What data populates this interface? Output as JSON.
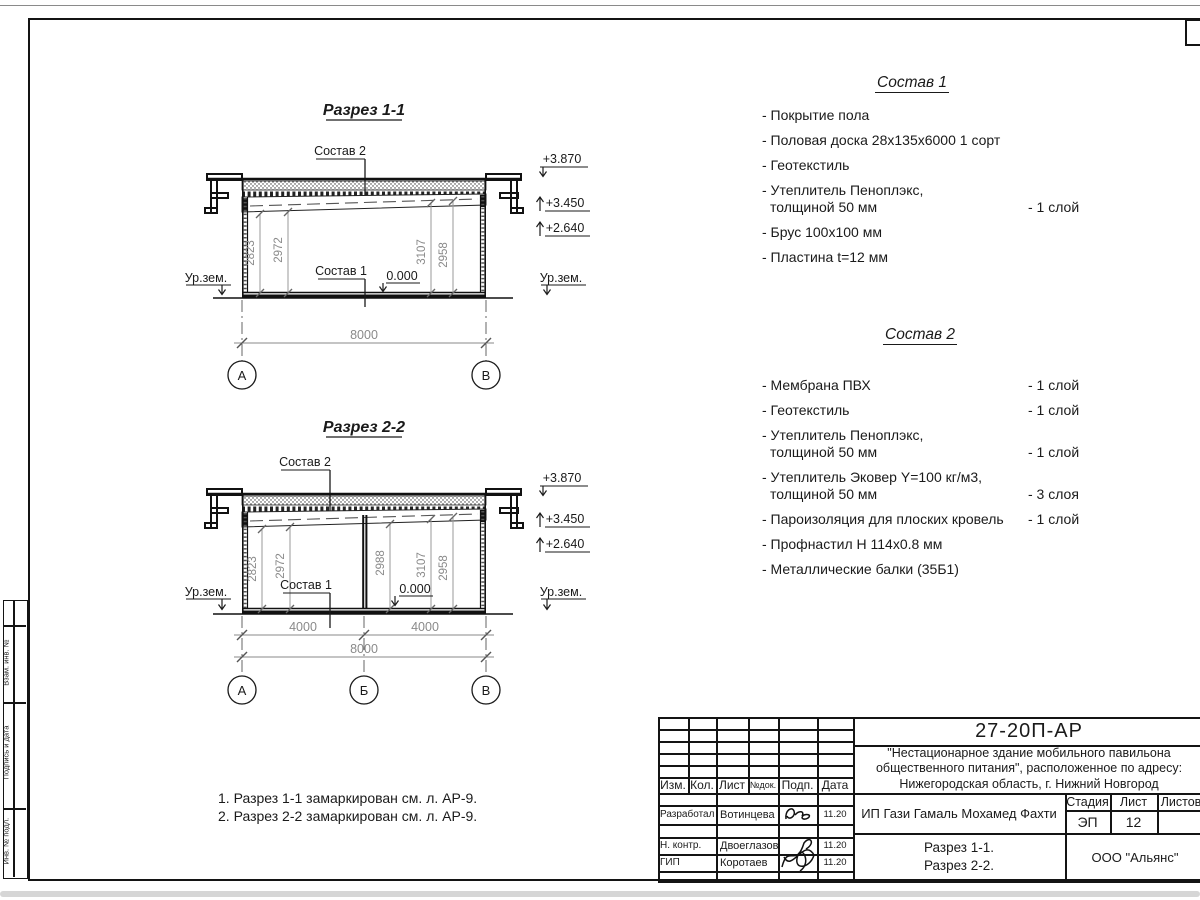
{
  "side_strip": {
    "labels": [
      "Взам. инв. №",
      "Подпись и дата",
      "Инв. № подл."
    ]
  },
  "sections": [
    {
      "title": "Разрез 1-1",
      "callout_roof": "Состав 2",
      "callout_floor": "Состав 1",
      "zero": "0.000",
      "ground_left": "Ур.зем.",
      "ground_right": "Ур.зем.",
      "levels": [
        "+3.870",
        "+3.450",
        "+2.640"
      ],
      "dims": [
        "2823",
        "2972",
        "3107",
        "2958"
      ],
      "overall": "8000",
      "axes": [
        "А",
        "В"
      ]
    },
    {
      "title": "Разрез 2-2",
      "callout_roof": "Состав 2",
      "callout_floor": "Состав 1",
      "zero": "0.000",
      "ground_left": "Ур.зем.",
      "ground_right": "Ур.зем.",
      "levels": [
        "+3.870",
        "+3.450",
        "+2.640"
      ],
      "dims": [
        "2823",
        "2972",
        "2988",
        "3107",
        "2958"
      ],
      "spans": [
        "4000",
        "4000"
      ],
      "overall": "8000",
      "axes": [
        "А",
        "Б",
        "В"
      ]
    }
  ],
  "spec1": {
    "title": "Состав 1",
    "items": [
      {
        "text": "- Покрытие пола",
        "text2": "",
        "qty": ""
      },
      {
        "text": "- Половая доска 28х135х6000 1 сорт",
        "text2": "",
        "qty": ""
      },
      {
        "text": "- Геотекстиль",
        "text2": "",
        "qty": ""
      },
      {
        "text": "- Утеплитель Пеноплэкс,",
        "text2": "толщиной 50 мм",
        "qty": "- 1 слой"
      },
      {
        "text": "- Брус 100х100 мм",
        "text2": "",
        "qty": ""
      },
      {
        "text": "- Пластина t=12 мм",
        "text2": "",
        "qty": ""
      }
    ]
  },
  "spec2": {
    "title": "Состав 2",
    "items": [
      {
        "text": "- Мембрана ПВХ",
        "text2": "",
        "qty": "- 1 слой"
      },
      {
        "text": "- Геотекстиль",
        "text2": "",
        "qty": "- 1 слой"
      },
      {
        "text": "- Утеплитель Пеноплэкс,",
        "text2": "толщиной 50 мм",
        "qty": "- 1 слой"
      },
      {
        "text": "- Утеплитель Эковер Y=100 кг/м3,",
        "text2": "толщиной 50 мм",
        "qty": "- 3 слоя"
      },
      {
        "text": "- Пароизоляция для плоских кровель",
        "text2": "",
        "qty": "- 1 слой"
      },
      {
        "text": "- Профнастил Н 114х0.8 мм",
        "text2": "",
        "qty": ""
      },
      {
        "text": "- Металлические балки (35Б1)",
        "text2": "",
        "qty": ""
      }
    ]
  },
  "notes": [
    "1. Разрез 1-1 замаркирован см. л. АР-9.",
    "2. Разрез 2-2 замаркирован см. л. АР-9."
  ],
  "titleblock": {
    "code": "27-20П-АР",
    "project_lines": [
      "\"Нестационарное здание мобильного павильона",
      "общественного питания\", расположенное по адресу:",
      "Нижегородская область, г. Нижний Новгород"
    ],
    "rev_headers": [
      "Изм.",
      "Кол.",
      "Лист",
      "№док.",
      "Подп.",
      "Дата"
    ],
    "staff": [
      {
        "role": "Разработал",
        "name": "Вотинцева",
        "date": "11.20"
      },
      {
        "role": "Н. контр.",
        "name": "Двоеглазов",
        "date": "11.20"
      },
      {
        "role": "ГИП",
        "name": "Коротаев",
        "date": "11.20"
      }
    ],
    "client": "ИП Гази Гамаль Мохамед Фахти",
    "stage_label": "Стадия",
    "sheet_label": "Лист",
    "sheets_label": "Листов",
    "stage": "ЭП",
    "sheet_no": "12",
    "doc_titles": [
      "Разрез 1-1.",
      "Разрез 2-2."
    ],
    "company": "ООО \"Альянс\""
  }
}
